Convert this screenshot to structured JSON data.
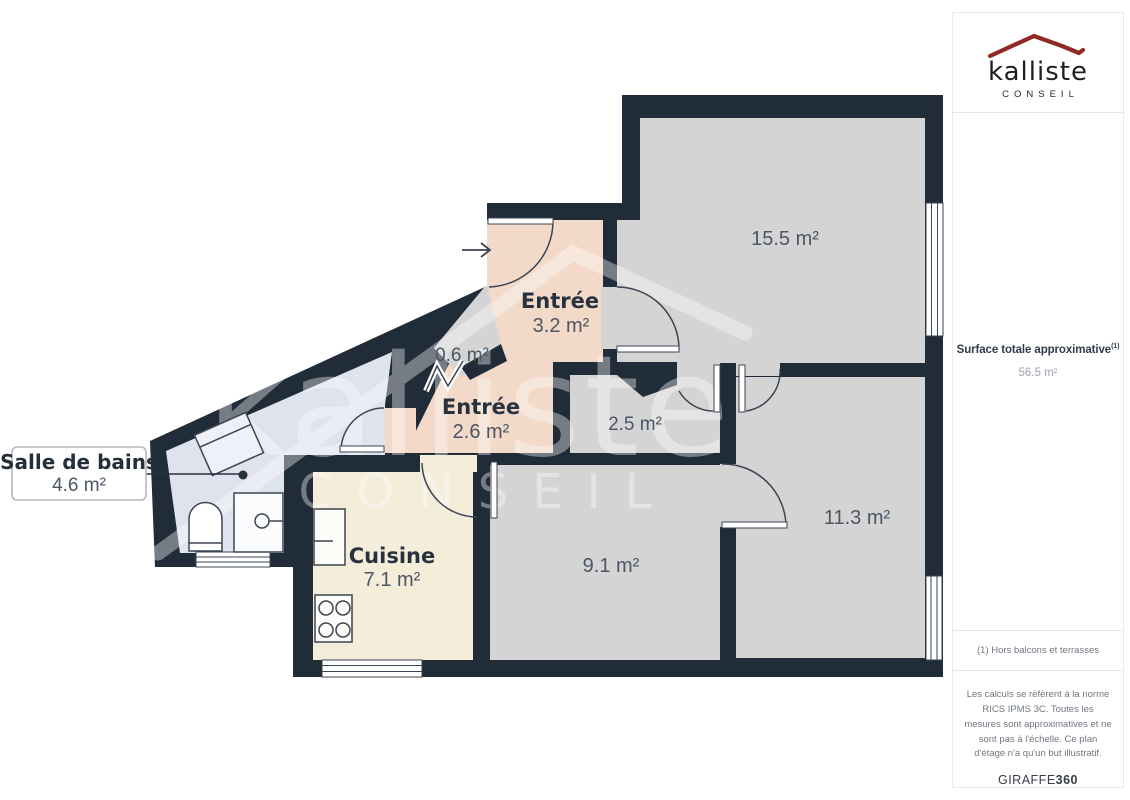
{
  "branding": {
    "name": "kalliste",
    "tagline": "CONSEIL",
    "roof_color": "#8e2a23"
  },
  "summary": {
    "label": "Surface totale approximative",
    "sup": "(1)",
    "value": "56.5 m²"
  },
  "footnote": "(1) Hors balcons et terrasses",
  "legal": "Les calculs se réfèrent à la norme RICS IPMS 3C. Toutes les mesures sont approximatives et ne sont pas à l'échelle. Ce plan d'étage n'a qu'un but illustratif.",
  "credit": {
    "brand": "GIRAFFE",
    "suffix": "360"
  },
  "floorplan": {
    "rooms": [
      {
        "name": "",
        "area": "15.5 m²"
      },
      {
        "name": "Entrée",
        "area": "3.2 m²"
      },
      {
        "name": "",
        "area": "0.6 m²"
      },
      {
        "name": "Entrée",
        "area": "2.6 m²"
      },
      {
        "name": "",
        "area": "2.5 m²"
      },
      {
        "name": "",
        "area": "11.3 m²"
      },
      {
        "name": "",
        "area": "9.1 m²"
      },
      {
        "name": "Cuisine",
        "area": "7.1 m²"
      },
      {
        "name": "Salle de bains",
        "area": "4.6 m²"
      }
    ],
    "watermark": {
      "text": "kalliste",
      "sub": "CONSEIL"
    },
    "colors": {
      "wall": "#212c39",
      "room_gray": "#d4d4d4",
      "hall_pink": "#f2d9c8",
      "kitchen_cream": "#f4edda",
      "bath_blue": "#dfe3ee",
      "outline": "#3b4553",
      "window_white": "#ffffff"
    }
  }
}
